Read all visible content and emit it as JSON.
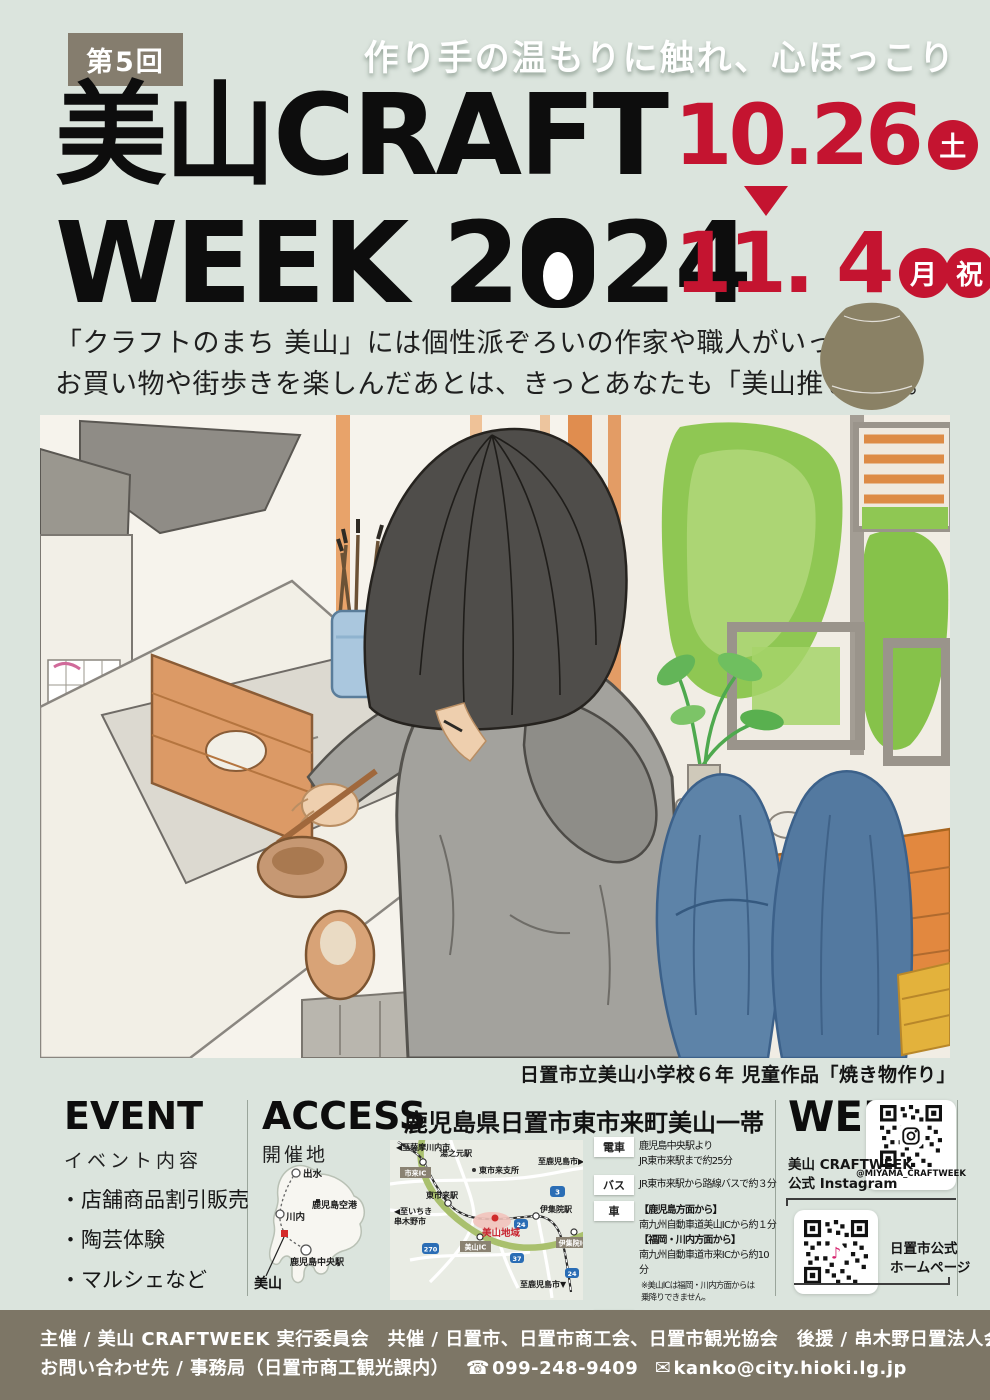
{
  "header": {
    "edition": "第5回",
    "tagline": "作り手の温もりに触れ、心ほっこり",
    "title1": "美山CRAFT",
    "title2_pre": "WEEK 2",
    "title2_post": "24",
    "date_start": "10.26",
    "date_start_day": "土",
    "date_end": "11. 4",
    "date_end_day1": "月",
    "date_end_day2": "祝",
    "lead1": "「クラフトのまち 美山」には個性派ぞろいの作家や職人がいっぱい。",
    "lead2": "お買い物や街歩きを楽しんだあとは、きっとあなたも「美山推し」に。"
  },
  "artwork": {
    "caption": "日置市立美山小学校６年 児童作品「焼き物作り」"
  },
  "event": {
    "title": "EVENT",
    "subtitle": "イベント内容",
    "items": [
      "・店舗商品割引販売",
      "・陶芸体験",
      "・マルシェなど"
    ]
  },
  "access": {
    "title": "ACCESS",
    "area": "鹿児島県日置市東市来町美山一帯",
    "venue_label": "開催地",
    "pref_map": {
      "izumi": "出水",
      "sendai": "川内",
      "airport": "鹿児島空港",
      "chuo_st": "鹿児島中央駅",
      "miyama": "美山"
    },
    "road_map": {
      "to_satsumasendai": "◀至薩摩川内市",
      "yunomoto_st": "湯之元駅",
      "ichiki_ic": "市来IC",
      "shisho": "東市来支所",
      "to_kagoshima_right": "至鹿児島市▶",
      "r3": "3",
      "higashiichiki_st": "東市来駅",
      "to_ichikikushikino1": "◀至いちき",
      "to_ichikikushikino2": "串木野市",
      "ijuin_st": "伊集院駅",
      "miyama_area": "美山地域",
      "r24a": "24",
      "miyama_ic": "美山IC",
      "ijuin_ic": "伊集院IC",
      "r270": "270",
      "r37": "37",
      "to_kagoshima_down": "至鹿児島市▼",
      "r24b": "24"
    },
    "transport": {
      "train": {
        "label": "電車",
        "l1": "鹿児島中央駅より",
        "l2": "JR東市来駅まで約25分"
      },
      "bus": {
        "label": "バス",
        "l1": "JR東市来駅から路線バスで約３分"
      },
      "car": {
        "label": "車",
        "h1": "【鹿児島方面から】",
        "l1": "南九州自動車道美山ICから約１分",
        "h2": "【福岡・川内方面から】",
        "l2": "南九州自動車道市来ICから約10分",
        "n1": "※美山ICは福岡・川内方面からは",
        "n2": "乗降りできません。"
      },
      "parking": {
        "label": "駐車場",
        "l1": "美山地区内に臨時駐車場あり"
      }
    }
  },
  "web": {
    "title": "WEB",
    "insta_l1": "美山 CRAFTWEEK",
    "insta_l2": "公式 Instagram",
    "insta_handle": "@MIYAMA_CRAFTWEEK",
    "hp_l1": "日置市公式",
    "hp_l2": "ホームページ"
  },
  "footer": {
    "line1": "主催 / 美山 CRAFTWEEK 実行委員会　共催 / 日置市、日置市商工会、日置市観光協会　後援 / 串木野日置法人会",
    "contact": "お問い合わせ先 / 事務局（日置市商工観光課内）",
    "phone": "099-248-9409",
    "email": "kanko@city.hioki.lg.jp"
  },
  "icons": {
    "phone": "☎",
    "mail": "✉",
    "music_note": "♪"
  },
  "colors": {
    "accent_red": "#c41430",
    "olive": "#857d6e",
    "footer_bg": "#7d7666",
    "background": "#dbe4dd"
  }
}
